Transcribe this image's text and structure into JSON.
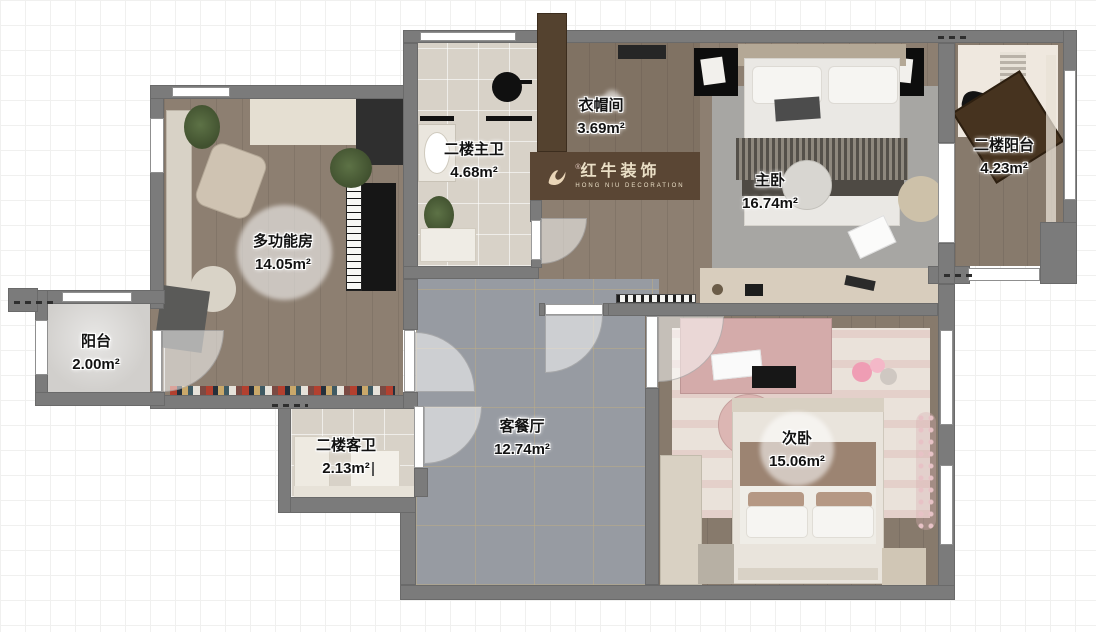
{
  "logo": {
    "name": "红牛装饰",
    "subtitle": "HONG NIU DECORATION",
    "registered": "®",
    "band_color": "#5a4634",
    "text_color": "#eadFC6"
  },
  "rooms": [
    {
      "key": "multi-function",
      "label": "多功能房",
      "area": "14.05m²"
    },
    {
      "key": "balcony",
      "label": "阳台",
      "area": "2.00m²"
    },
    {
      "key": "master-bath",
      "label": "二楼主卫",
      "area": "4.68m²"
    },
    {
      "key": "cloakroom",
      "label": "衣帽间",
      "area": "3.69m²"
    },
    {
      "key": "master-bedroom",
      "label": "主卧",
      "area": "16.74m²"
    },
    {
      "key": "upper-balcony",
      "label": "二楼阳台",
      "area": "4.23m²"
    },
    {
      "key": "living-dining",
      "label": "客餐厅",
      "area": "12.74m²"
    },
    {
      "key": "guest-bath",
      "label": "二楼客卫",
      "area": "2.13m²"
    },
    {
      "key": "second-bedroom",
      "label": "次卧",
      "area": "15.06m²"
    }
  ],
  "colors": {
    "wall": "#7b7b7b",
    "wood_floor": "#8d7f71",
    "gray_tile": "#979ba2",
    "warm_tile": "#d8d2c8",
    "brand_band": "#5a4634"
  }
}
